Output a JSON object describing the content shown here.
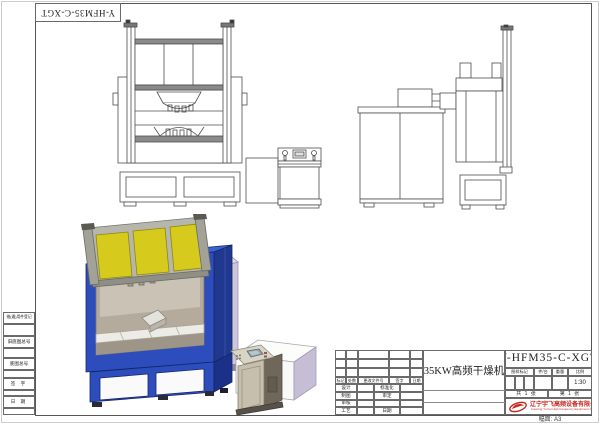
{
  "sheet": {
    "drawing_number": "Y-HFM35-C-XGT",
    "part_name": "35KW高频干燥机",
    "paper_size_label": "幅面: A3"
  },
  "title_block": {
    "mark_header": "图样标记",
    "qty_header": "件/台",
    "weight_header": "重量",
    "scale_header": "比例",
    "scale_value": "1:30",
    "sheets_total": "共 1 张",
    "sheet_index": "第 1 张",
    "revision_columns": [
      "标记",
      "处数",
      "更改文件号",
      "签字",
      "日期"
    ],
    "roles_left": [
      "设计",
      "制图",
      "审核",
      "工艺"
    ],
    "roles_right": [
      "标准化",
      "审定",
      "",
      "日期"
    ],
    "company_name": "辽宁宇飞高频设备有限公司",
    "company_name_en": "Liaoning Yu Fei High Frequency Equipment Co., Ltd."
  },
  "margin_block": {
    "rows": [
      "借(通)用件登记",
      "旧底图总号",
      "底图总号",
      "签 字",
      "日 期"
    ]
  },
  "colors": {
    "machine_blue": "#2c4dbb",
    "machine_blue_dark": "#20398f",
    "panel_yellow": "#d6ca1d",
    "logo_red": "#c8281e",
    "line": "#4d4d4d"
  }
}
